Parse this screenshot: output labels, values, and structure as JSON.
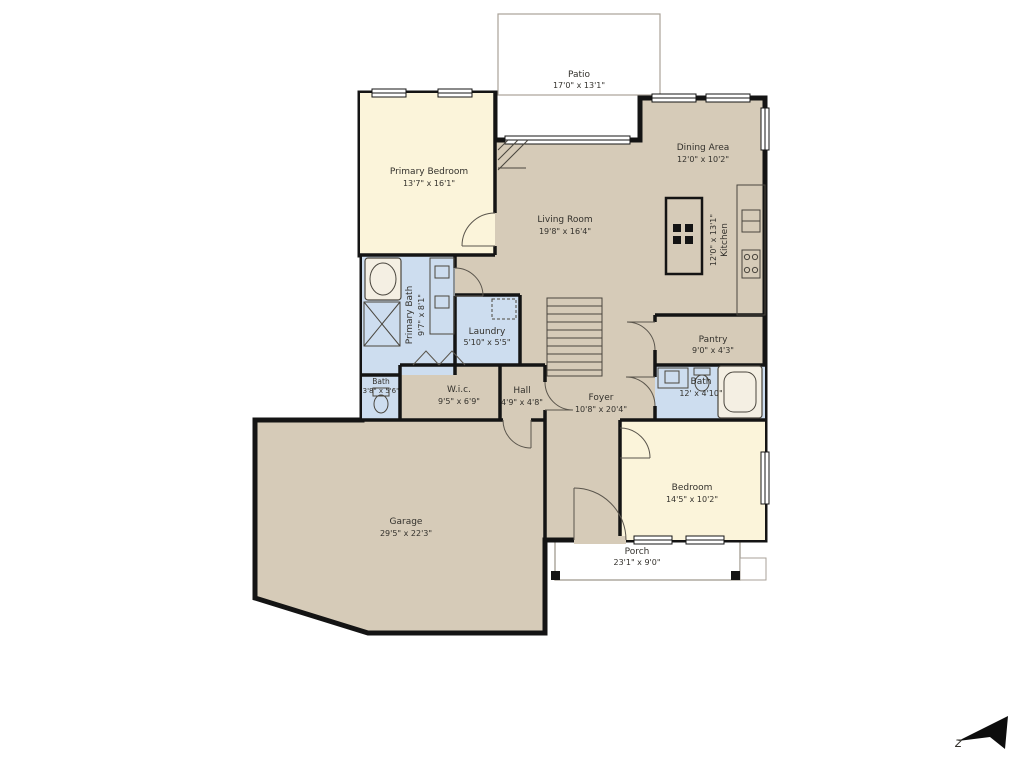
{
  "plan": {
    "rooms": {
      "patio": {
        "name": "Patio",
        "dims": "17'0\" x 13'1\""
      },
      "primary_bedroom": {
        "name": "Primary Bedroom",
        "dims": "13'7\" x 16'1\""
      },
      "living": {
        "name": "Living Room",
        "dims": "19'8\" x 16'4\""
      },
      "dining": {
        "name": "Dining Area",
        "dims": "12'0\" x 10'2\""
      },
      "kitchen": {
        "name": "Kitchen",
        "dims": "12'0\" x 13'1\""
      },
      "primary_bath": {
        "name": "Primary Bath",
        "dims": "9'7\" x 8'1\""
      },
      "laundry": {
        "name": "Laundry",
        "dims": "5'10\" x 5'5\""
      },
      "bath_left": {
        "name": "Bath",
        "dims": "3'8\" x 5'6\""
      },
      "wic": {
        "name": "W.i.c.",
        "dims": "9'5\" x 6'9\""
      },
      "hall": {
        "name": "Hall",
        "dims": "4'9\" x 4'8\""
      },
      "foyer": {
        "name": "Foyer",
        "dims": "10'8\" x 20'4\""
      },
      "pantry": {
        "name": "Pantry",
        "dims": "9'0\" x 4'3\""
      },
      "bath_right": {
        "name": "Bath",
        "dims": "12' x 4'10\""
      },
      "bedroom": {
        "name": "Bedroom",
        "dims": "14'5\" x 10'2\""
      },
      "garage": {
        "name": "Garage",
        "dims": "29'5\" x 22'3\""
      },
      "porch": {
        "name": "Porch",
        "dims": "23'1\" x 9'0\""
      }
    },
    "compass": {
      "label": "z"
    },
    "colors": {
      "floor_tan": "#d6cbb8",
      "bedroom_cream": "#fbf4da",
      "bath_blue": "#cdddef",
      "wall_black": "#141414",
      "outdoor_border": "#a9a298"
    }
  }
}
